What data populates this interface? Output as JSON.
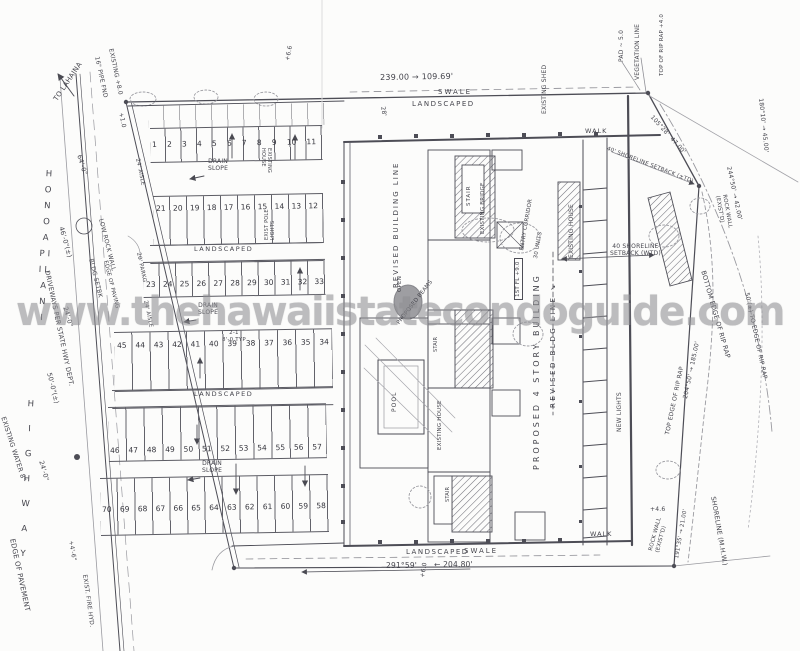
{
  "watermark": {
    "text": "www.thehawaiistatecondoguide.com"
  },
  "highway": {
    "to_lahaina": "TO LAHAINA",
    "name_upper": "H O N O A P I I L A N I",
    "name_lower": "H I G H W A Y",
    "driveways_note": "DRIVEWAYS PER STATE HWY DEPT.",
    "existing_water": "EXISTING WATER 8\"",
    "edge_of_pavement": "EDGE OF PAVEMENT",
    "fire_hydrant": "EXIST. FIRE HYD.",
    "pipe_found": "16\" PIPE FND",
    "spot_existing": "EXISTING +8.0",
    "spot_10": "+1.0",
    "dim_64": "64'-0\"",
    "dim_46": "46'-0\"(±)",
    "low_rock_wall": "LOW ROCK WALL",
    "bldg_setback": "BLDG SETBK",
    "dim_24": "24'-0\"",
    "dim_50": "50'-0\"(±)",
    "dim_24b": "24'-0\"",
    "spot_46": "+4'-6\""
  },
  "boundary": {
    "top_dim": "239.00 → 109.69'",
    "spot_66": "+6.6",
    "swale_top": "SWALE",
    "landscaped_top": "LANDSCAPED",
    "dim_28": "28'",
    "bottom_bearing": "291°59'",
    "bottom_dim": "← 204.80'",
    "landscaped_bottom": "LANDSCAPED",
    "swale_bottom": "SWALE",
    "spot_60": "+6.0"
  },
  "parking": {
    "rows": [
      {
        "stalls": [
          "1",
          "2",
          "3",
          "4",
          "5",
          "6",
          "7",
          "8",
          "9",
          "10",
          "11"
        ]
      },
      {
        "stalls": [
          "21",
          "20",
          "19",
          "18",
          "17",
          "16",
          "15",
          "14",
          "13",
          "12"
        ]
      },
      {
        "stalls": [
          "23",
          "24",
          "25",
          "26",
          "27",
          "28",
          "29",
          "30",
          "31",
          "32",
          "33"
        ]
      },
      {
        "stalls": [
          "45",
          "44",
          "43",
          "42",
          "41",
          "40",
          "39",
          "38",
          "37",
          "36",
          "35",
          "34"
        ]
      },
      {
        "stalls": [
          "46",
          "47",
          "48",
          "49",
          "50",
          "51",
          "52",
          "53",
          "54",
          "55",
          "56",
          "57"
        ]
      },
      {
        "stalls": [
          "70",
          "69",
          "68",
          "67",
          "66",
          "65",
          "64",
          "63",
          "62",
          "61",
          "60",
          "59",
          "58"
        ]
      }
    ],
    "drain_slope": "DRAIN\nSLOPE",
    "landscaped": "LANDSCAPED",
    "typ_note": "2-1\n8'-0 TYP",
    "aisle": "24' AISLE",
    "stall_depth": "20' PARKG",
    "edge_of_paving": "EDGE OF PAVING",
    "pole_lights": "EXIST POLE\nLIGHTS",
    "existing_house": "EXISTING\nHOUSE"
  },
  "building": {
    "revised_building_line": "REVISED BUILDING LINE",
    "revised_bldg_line": "REVISED BLDG LINE ↘",
    "proposed": "PROPOSED 4 STORY BUILDING",
    "first_floor": "1ST FL +9.0",
    "stair": "STAIR",
    "existing_bridge": "EXISTING BRIDGE",
    "entry_corridor": "ENTRY CORRIDOR",
    "units": "30 UNITS",
    "open": "OPEN",
    "beams": "PROPOSED BEAMS",
    "pool": "POOL",
    "existing_house": "EXISTING HOUSE",
    "existing_shed": "EXISTING SHED",
    "walk": "WALK",
    "new_lights": "NEW LIGHTS"
  },
  "shore": {
    "vegetation_line": "VEGETATION LINE",
    "pad": "PAD ~ 5.0",
    "rip_rap_top": "TOP OF RIP RAP +4.0",
    "bearing_1": "105°28'  47.00'",
    "bearing_2": "244°50' → 42.00'",
    "bearing_3": "180°10' → 45.00'",
    "bearing_4": "204°50' → 185.00'",
    "bearing_5": "191°35' → 21.00'",
    "setback_diag": "40' SHORELINE SETBACK (±TD)",
    "setback_note": "40 SHORELINE\nSETBACK (WTD)",
    "rock_wall": "ROCK WALL\n(EXIST'D)",
    "bottom_edge": "BOTTOM EDGE OF RIP RAP",
    "top_edge": "TOP EDGE OF RIP RAP",
    "to_edge": "50'(±) TO EDGE OF RIP RAP",
    "shoreline": "SHORELINE (M.H.W.)",
    "spot_46": "+4.6"
  }
}
